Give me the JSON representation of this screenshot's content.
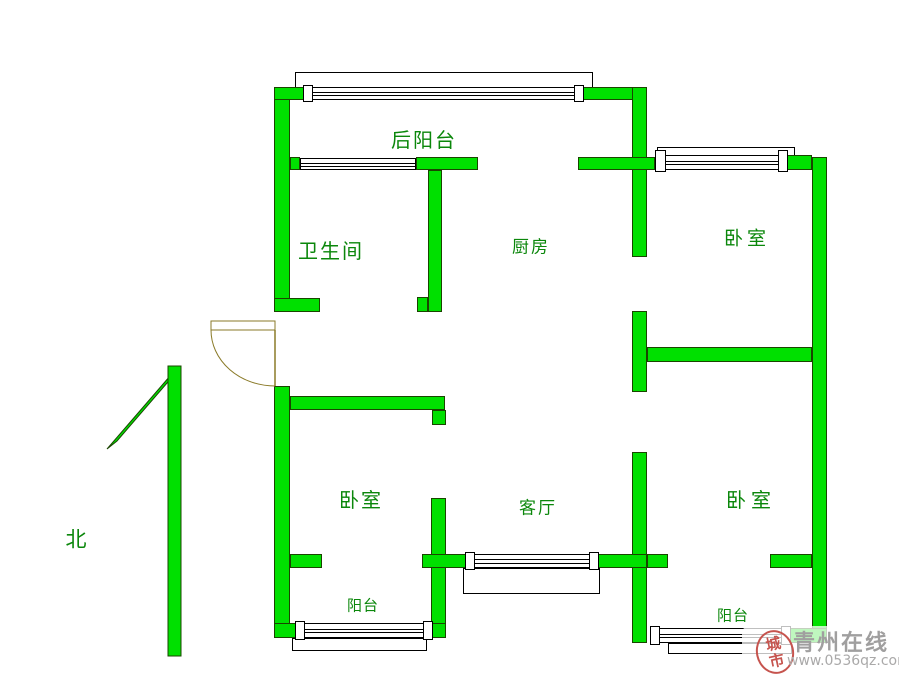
{
  "meta": {
    "width": 899,
    "height": 691
  },
  "colors": {
    "wall_green": "#00e000",
    "wall_outline": "#1a4400",
    "door_olive": "#8a7a28",
    "label_green": "#0b870b",
    "watermark_grey": "#a09f9f",
    "seal_red": "#c6544e"
  },
  "floorplan": {
    "walls": [
      {
        "name": "left-wall-upper",
        "x": 274,
        "y": 87,
        "w": 16,
        "h": 225
      },
      {
        "name": "left-wall-lower",
        "x": 274,
        "y": 386,
        "w": 16,
        "h": 252
      },
      {
        "name": "top-wall-left",
        "x": 274,
        "y": 87,
        "w": 36,
        "h": 13
      },
      {
        "name": "top-wall-right",
        "x": 582,
        "y": 87,
        "w": 63,
        "h": 13
      },
      {
        "name": "center-wall-upper",
        "x": 632,
        "y": 87,
        "w": 15,
        "h": 170
      },
      {
        "name": "center-wall-middle",
        "x": 632,
        "y": 311,
        "w": 15,
        "h": 81
      },
      {
        "name": "center-wall-lower",
        "x": 632,
        "y": 452,
        "w": 15,
        "h": 191
      },
      {
        "name": "back-balcony-wall-left",
        "x": 290,
        "y": 157,
        "w": 10,
        "h": 13
      },
      {
        "name": "back-balcony-wall-mid",
        "x": 416,
        "y": 157,
        "w": 62,
        "h": 13
      },
      {
        "name": "back-balcony-wall-right",
        "x": 578,
        "y": 157,
        "w": 77,
        "h": 13
      },
      {
        "name": "bath-kitchen-wall",
        "x": 428,
        "y": 170,
        "w": 14,
        "h": 142
      },
      {
        "name": "bath-kitchen-wall-foot",
        "x": 417,
        "y": 297,
        "w": 11,
        "h": 15
      },
      {
        "name": "bath-south-wall",
        "x": 274,
        "y": 298,
        "w": 46,
        "h": 14
      },
      {
        "name": "ne-bedroom-top-wall",
        "x": 787,
        "y": 155,
        "w": 25,
        "h": 15
      },
      {
        "name": "right-wall",
        "x": 812,
        "y": 157,
        "w": 15,
        "h": 486
      },
      {
        "name": "right-bedrooms-divider",
        "x": 647,
        "y": 347,
        "w": 165,
        "h": 15
      },
      {
        "name": "sw-bedroom-top-wall",
        "x": 290,
        "y": 396,
        "w": 155,
        "h": 14
      },
      {
        "name": "sw-bedroom-top-stub",
        "x": 432,
        "y": 410,
        "w": 14,
        "h": 15
      },
      {
        "name": "sw-bedroom-right-wall",
        "x": 431,
        "y": 498,
        "w": 15,
        "h": 140
      },
      {
        "name": "south-wall-stub-a",
        "x": 290,
        "y": 554,
        "w": 32,
        "h": 14
      },
      {
        "name": "south-wall-mid",
        "x": 422,
        "y": 554,
        "w": 51,
        "h": 14
      },
      {
        "name": "south-wall-right",
        "x": 598,
        "y": 554,
        "w": 49,
        "h": 14
      },
      {
        "name": "south-wall-stub-b",
        "x": 647,
        "y": 554,
        "w": 21,
        "h": 14
      },
      {
        "name": "se-bedroom-south-wall",
        "x": 770,
        "y": 554,
        "w": 42,
        "h": 14
      },
      {
        "name": "sw-balcony-bottom-left",
        "x": 274,
        "y": 623,
        "w": 26,
        "h": 15
      },
      {
        "name": "sw-balcony-bottom-right",
        "x": 428,
        "y": 623,
        "w": 18,
        "h": 15
      },
      {
        "name": "se-balcony-bottom-right",
        "x": 790,
        "y": 628,
        "w": 37,
        "h": 15
      }
    ],
    "sills": [
      {
        "name": "back-balcony-window-sill",
        "x": 295,
        "y": 72,
        "w": 298,
        "h": 16
      },
      {
        "name": "ne-bedroom-window-sill",
        "x": 657,
        "y": 147,
        "w": 138,
        "h": 10
      },
      {
        "name": "living-room-window-sill",
        "x": 463,
        "y": 568,
        "w": 137,
        "h": 26
      },
      {
        "name": "sw-balcony-window-sill",
        "x": 292,
        "y": 638,
        "w": 135,
        "h": 13
      },
      {
        "name": "se-balcony-window-sill",
        "x": 668,
        "y": 643,
        "w": 124,
        "h": 11
      }
    ],
    "windows": [
      {
        "name": "back-balcony-window",
        "x": 310,
        "y": 87,
        "w": 272,
        "h": 13
      },
      {
        "name": "bathroom-window",
        "x": 300,
        "y": 158,
        "w": 116,
        "h": 12
      },
      {
        "name": "ne-bedroom-window",
        "x": 665,
        "y": 155,
        "w": 122,
        "h": 15
      },
      {
        "name": "living-room-window",
        "x": 468,
        "y": 554,
        "w": 130,
        "h": 14
      },
      {
        "name": "sw-balcony-window",
        "x": 300,
        "y": 623,
        "w": 128,
        "h": 15
      },
      {
        "name": "se-balcony-window",
        "x": 658,
        "y": 628,
        "w": 132,
        "h": 15
      }
    ],
    "frames": [
      {
        "x": 303,
        "y": 85,
        "w": 10,
        "h": 17
      },
      {
        "x": 574,
        "y": 85,
        "w": 10,
        "h": 17
      },
      {
        "x": 655,
        "y": 150,
        "w": 11,
        "h": 22
      },
      {
        "x": 778,
        "y": 150,
        "w": 10,
        "h": 22
      },
      {
        "x": 465,
        "y": 552,
        "w": 10,
        "h": 18
      },
      {
        "x": 589,
        "y": 552,
        "w": 10,
        "h": 18
      },
      {
        "x": 295,
        "y": 621,
        "w": 10,
        "h": 19
      },
      {
        "x": 423,
        "y": 621,
        "w": 10,
        "h": 19
      },
      {
        "x": 650,
        "y": 626,
        "w": 10,
        "h": 19
      },
      {
        "x": 781,
        "y": 626,
        "w": 10,
        "h": 19
      }
    ],
    "door": {
      "leaf": {
        "x": 211,
        "y": 321,
        "w": 64,
        "h": 9
      },
      "arc_path": "M 211 330 A 64 56 0 0 0 275 386",
      "hinge": {
        "x1": 275,
        "y1": 330,
        "x2": 275,
        "y2": 386
      }
    },
    "north_arrow": {
      "bar": {
        "x": 168,
        "y": 366,
        "w": 13,
        "h": 290
      },
      "head_points": "180,368 117,441 107,449 170,376"
    },
    "labels": [
      {
        "name": "label-back-balcony",
        "text": "后阳台",
        "x": 424,
        "y": 140,
        "size": 20,
        "spacing": 2
      },
      {
        "name": "label-bathroom",
        "text": "卫生间",
        "x": 331,
        "y": 251,
        "size": 20,
        "spacing": 2
      },
      {
        "name": "label-kitchen",
        "text": "厨房",
        "x": 531,
        "y": 248,
        "size": 17,
        "spacing": 2
      },
      {
        "name": "label-bedroom-ne",
        "text": "卧室",
        "x": 747,
        "y": 239,
        "size": 19,
        "spacing": 4
      },
      {
        "name": "label-bedroom-sw",
        "text": "卧室",
        "x": 361,
        "y": 500,
        "size": 20,
        "spacing": 2
      },
      {
        "name": "label-living-room",
        "text": "客厅",
        "x": 538,
        "y": 509,
        "size": 17,
        "spacing": 2
      },
      {
        "name": "label-bedroom-se",
        "text": "卧室",
        "x": 751,
        "y": 500,
        "size": 20,
        "spacing": 5
      },
      {
        "name": "label-balcony-sw",
        "text": "阳台",
        "x": 363,
        "y": 606,
        "size": 15,
        "spacing": 1
      },
      {
        "name": "label-balcony-se",
        "text": "阳台",
        "x": 733,
        "y": 616,
        "size": 15,
        "spacing": 1
      },
      {
        "name": "label-north",
        "text": "北",
        "x": 76,
        "y": 540,
        "size": 21,
        "spacing": 0
      }
    ]
  },
  "watermark": {
    "seal_top": "城",
    "seal_bottom": "市",
    "site_name": "青州在线",
    "url": "www.0536qz.com"
  }
}
